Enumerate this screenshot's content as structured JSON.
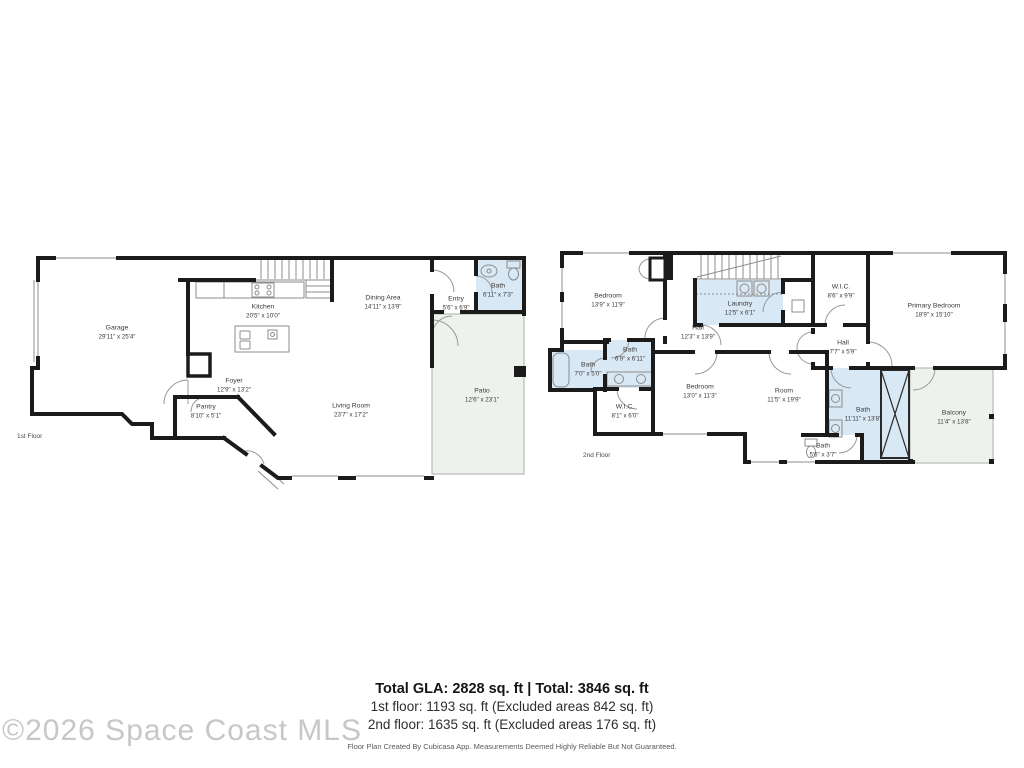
{
  "watermark": "©2026 Space Coast MLS",
  "colors": {
    "wall": "#1b1b1b",
    "bath_fill": "#d9e8f5",
    "outdoor_fill": "#edf3ec",
    "thin_line": "#8c8c8c",
    "label_text": "#3a3a3a",
    "watermark_gray": "#c7c7c7"
  },
  "floors": [
    {
      "caption": "1st Floor",
      "rooms": [
        {
          "name": "Garage",
          "dims": "29'11\" x 25'4\""
        },
        {
          "name": "Kitchen",
          "dims": "20'5\" x 10'0\""
        },
        {
          "name": "Dining Area",
          "dims": "14'11\" x 13'9\""
        },
        {
          "name": "Entry",
          "dims": "5'6\" x 6'9\""
        },
        {
          "name": "Bath",
          "dims": "6'11\" x 7'3\""
        },
        {
          "name": "Foyer",
          "dims": "12'9\" x 13'2\""
        },
        {
          "name": "Pantry",
          "dims": "8'10\" x 5'1\""
        },
        {
          "name": "Living Room",
          "dims": "23'7\" x 17'2\""
        },
        {
          "name": "Patio",
          "dims": "12'6\" x 23'1\""
        }
      ]
    },
    {
      "caption": "2nd Floor",
      "rooms": [
        {
          "name": "Bedroom",
          "dims": "13'9\" x 11'9\""
        },
        {
          "name": "Laundry",
          "dims": "12'5\" x 6'1\""
        },
        {
          "name": "W.I.C.",
          "dims": "8'6\" x 9'9\""
        },
        {
          "name": "Primary Bedroom",
          "dims": "18'9\" x 15'10\""
        },
        {
          "name": "Hall",
          "dims": "12'3\" x 13'9\""
        },
        {
          "name": "Hall",
          "dims": "7'7\" x 5'9\""
        },
        {
          "name": "Bath",
          "dims": "6'9\" x 6'11\""
        },
        {
          "name": "Bath",
          "dims": "7'0\" x 5'0\""
        },
        {
          "name": "Bedroom",
          "dims": "13'0\" x 11'3\""
        },
        {
          "name": "W.I.C.",
          "dims": "8'1\" x 6'0\""
        },
        {
          "name": "Room",
          "dims": "11'5\" x 19'9\""
        },
        {
          "name": "Bath",
          "dims": "11'11\" x 13'8\""
        },
        {
          "name": "Balcony",
          "dims": "11'4\" x 13'8\""
        },
        {
          "name": "Bath",
          "dims": "5'6\" x 3'7\""
        }
      ]
    }
  ],
  "summary": {
    "total": "Total GLA: 2828 sq. ft | Total: 3846 sq. ft",
    "floor1": "1st floor: 1193 sq. ft (Excluded areas 842 sq. ft)",
    "floor2": "2nd floor: 1635 sq. ft (Excluded areas 176 sq. ft)",
    "disclaimer": "Floor Plan Created By Cubicasa App. Measurements Deemed Highly Reliable But Not Guaranteed."
  }
}
